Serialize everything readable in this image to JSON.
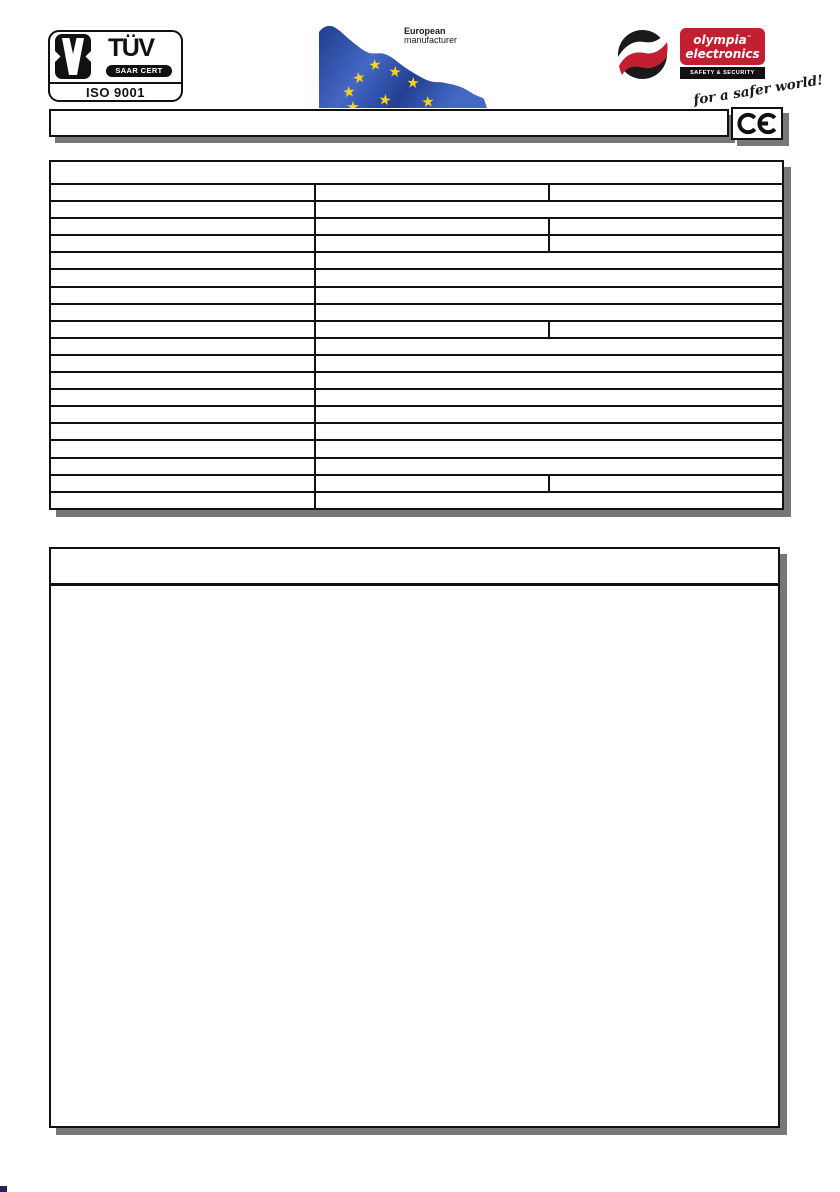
{
  "header": {
    "tuv_logo": {
      "name": "TÜV",
      "cert_badge": "SAAR CERT",
      "iso_label": "ISO 9001"
    },
    "eu_manufacturer": {
      "line1": "European",
      "line2": "manufacturer"
    },
    "olympia_logo": {
      "brand_line1": "olympia",
      "trademark": "™",
      "brand_line2": "electronics",
      "bar_text": "SAFETY & SECURITY SYSTEMS",
      "slogan": "for a safer world!"
    },
    "ce_mark": "CE"
  },
  "title_bar": {
    "text": ""
  },
  "spec_table": {
    "header_text": "",
    "row_layouts": [
      3,
      2,
      3,
      3,
      2,
      2,
      2,
      2,
      3,
      2,
      2,
      2,
      2,
      2,
      2,
      2,
      2,
      3,
      2
    ],
    "cell_text": ""
  },
  "description_panel": {
    "header_text": "",
    "body_text": ""
  },
  "colors": {
    "brand_red": "#c22031",
    "flag_blue_dark": "#1f3c8f",
    "flag_blue_mid": "#4468c4",
    "flag_blue_deep": "#233f93",
    "star_yellow": "#ffd21e",
    "shadow_gray": "#777777",
    "ink": "#1a1a1a"
  }
}
